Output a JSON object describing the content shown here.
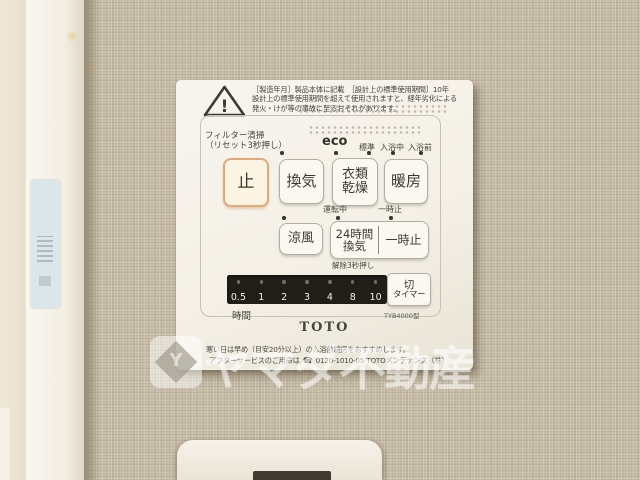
{
  "panel": {
    "warning": {
      "line1": "［製造年月］製品本体に記載　［設計上の標準使用期間］10年",
      "line2": "設計上の標準使用期間を超えて使用されますと、経年劣化による",
      "line3": "発火・けが等の事故に至るおそれがあります。"
    },
    "labels": {
      "filter_clean": "フィルター清掃",
      "filter_reset": "（リセット3秒押し）",
      "eco": "eco",
      "standard": "標準",
      "bathing": "入浴中",
      "pre_bath": "入浴前",
      "operating": "運転中",
      "pause_indicator": "一時止",
      "release_hold": "解除3秒押し",
      "hours": "時間",
      "model": "TYB4000型"
    },
    "buttons": {
      "stop": "止",
      "ventilation": "換気",
      "clothes_dry_line1": "衣類",
      "clothes_dry_line2": "乾燥",
      "heating": "暖房",
      "cool_breeze": "涼風",
      "vent24_line1": "24時間",
      "vent24_line2": "換気",
      "pause": "一時止",
      "off_timer_line1": "切",
      "off_timer_line2": "タイマー"
    },
    "timer": {
      "values": [
        "0.5",
        "1",
        "2",
        "3",
        "4",
        "8",
        "10"
      ]
    },
    "brand": "TOTO",
    "footer": {
      "line1": "寒い日は早め（目安20分以上）の入浴前暖房をおすすめします。",
      "line2_prefix": "アフターサービスのご用命は",
      "phone_icon": "☎",
      "phone": "0120-1010-05",
      "line2_suffix": "TOTOメンテナンス（株）"
    }
  },
  "watermark": {
    "text": "ヤマダ不動産",
    "logo_letter": "Y"
  },
  "colors": {
    "wallpaper": "#c6bba6",
    "panel_body": "#f5f1e8",
    "stop_button_border": "#e2a977",
    "timer_strip_bg": "#201e19",
    "watermark_white": "rgba(255,255,255,0.48)"
  }
}
